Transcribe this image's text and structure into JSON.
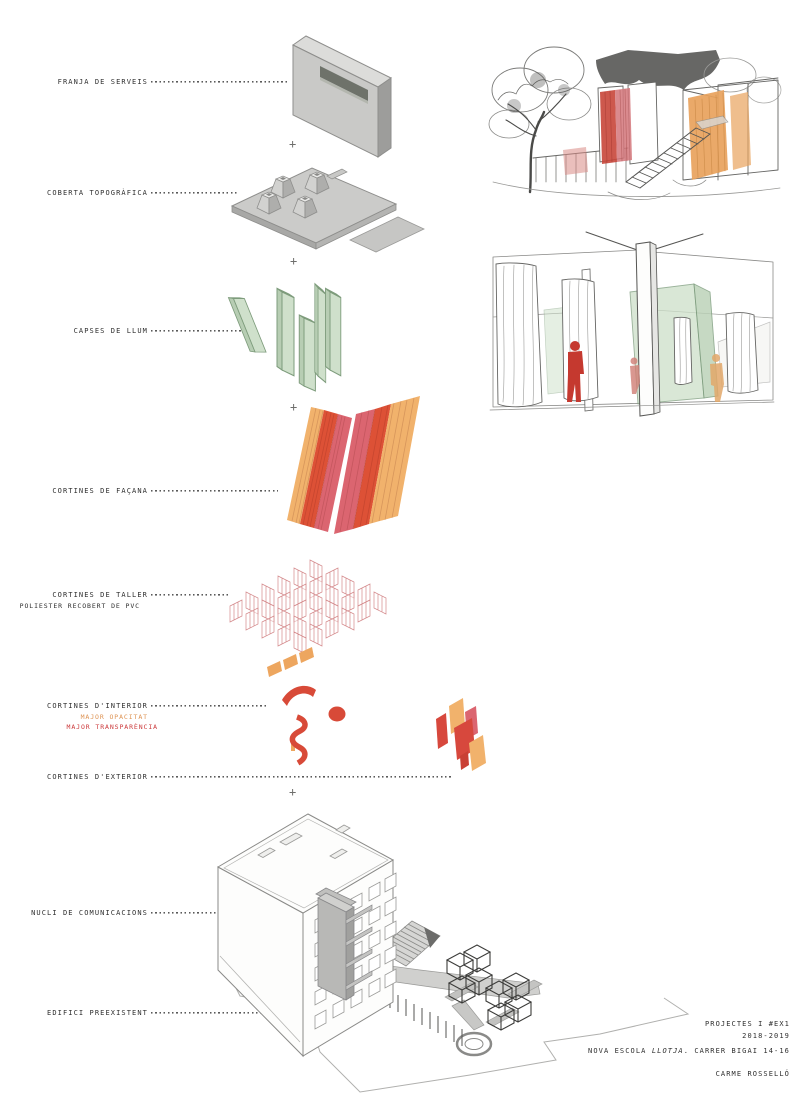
{
  "board": {
    "plus": "+",
    "labels": {
      "franja": {
        "text": "FRANJA DE SERVEIS"
      },
      "coberta": {
        "text": "COBERTA TOPOGRÀFICA"
      },
      "capses": {
        "text": "CAPSES DE LLUM"
      },
      "facana": {
        "text": "CORTINES DE FAÇANA"
      },
      "taller": {
        "text": "CORTINES DE TALLER",
        "sub": "POLIESTER RECOBERT DE PVC"
      },
      "interior": {
        "text": "CORTINES D'INTERIOR",
        "sub_opacity": "MAJOR OPACITAT",
        "sub_transparency": "MAJOR TRANSPARÈNCIA"
      },
      "exterior": {
        "text": "CORTINES D'EXTERIOR"
      },
      "nucli": {
        "text": "NUCLI DE COMUNICACIONS"
      },
      "edifici": {
        "text": "EDIFICI PREEXISTENT"
      }
    },
    "credits": {
      "course": "PROJECTES I #EX1",
      "year": "2018-2019",
      "school_pre": "NOVA ESCOLA ",
      "school_italic": "LLOTJA",
      "school_post": ". CARRER BIGAI 14-16",
      "author": "CARME ROSSELLÓ"
    },
    "colors": {
      "curtain_orange": "#f1b26c",
      "curtain_red": "#dd5136",
      "curtain_pink": "#db6570",
      "interior_red": "#d84a38",
      "taller_pink_line": "#d4898b",
      "light_box_green": "#cfe0cb",
      "concrete_gray": "#c9c9c7",
      "label_text": "#2f2f2f",
      "sub_orange_text": "#de9455",
      "sub_red_text": "#cc3b3d"
    }
  }
}
